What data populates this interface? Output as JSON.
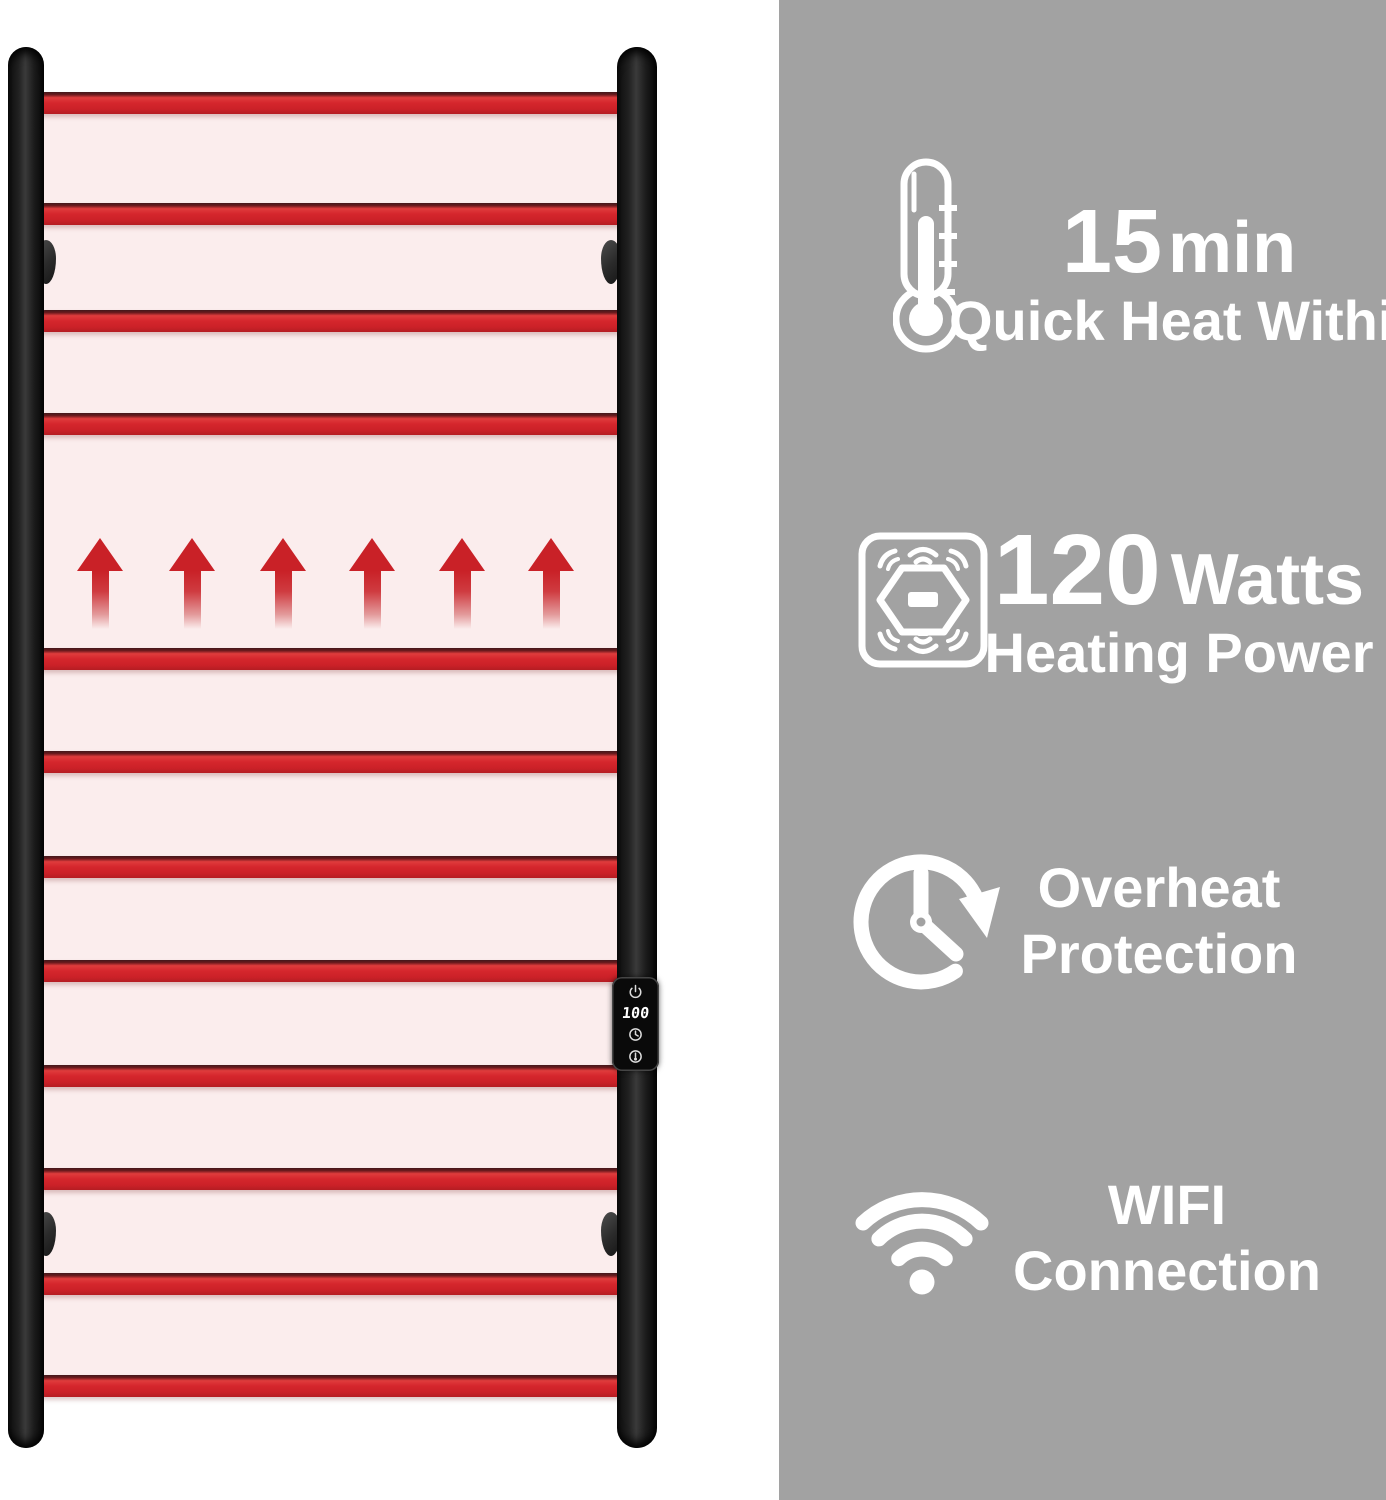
{
  "colors": {
    "panel_gray": "#a2a2a2",
    "rail_red": "#d5262c",
    "glow_pink": "#fbeded",
    "frame_black": "#1a1a1a",
    "text_white": "#ffffff"
  },
  "product": {
    "rails": {
      "count": 12,
      "y_positions": [
        92,
        203,
        310,
        413,
        648,
        751,
        856,
        960,
        1065,
        1168,
        1273,
        1375
      ]
    },
    "heat_arrows": {
      "count": 6,
      "x_centers": [
        100,
        192,
        283,
        372,
        462,
        551
      ],
      "top": 538
    },
    "control_panel": {
      "display": "100",
      "icons": [
        "power-icon",
        "clock-icon",
        "temperature-icon"
      ]
    }
  },
  "features": [
    {
      "id": "quick-heat",
      "icon": "thermometer-icon",
      "value": "15",
      "unit": "min",
      "caption": "Quick Heat Within"
    },
    {
      "id": "heating-power",
      "icon": "heating-power-icon",
      "value": "120",
      "unit": "Watts",
      "caption": "Heating Power"
    },
    {
      "id": "overheat-protection",
      "icon": "overheat-clock-icon",
      "line1": "Overheat",
      "line2": "Protection"
    },
    {
      "id": "wifi-connection",
      "icon": "wifi-icon",
      "line1": "WIFI",
      "line2": "Connection"
    }
  ]
}
